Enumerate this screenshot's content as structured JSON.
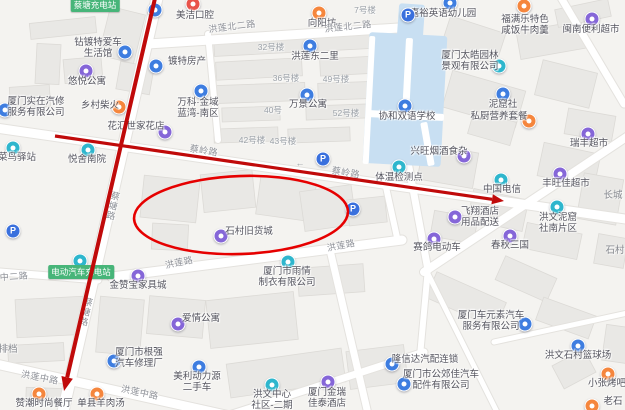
{
  "map": {
    "bg": "#f4f3f0",
    "road_fill": "#ffffff",
    "road_edge": "#e4e2de",
    "building_fill": "#e9e8e5",
    "building_edge": "#dcdad6",
    "water_fill": "#c8dff2",
    "annotation_color": "#c00a0a",
    "icon_colors": {
      "purple": "#8566d8",
      "blue": "#3e7de0",
      "teal": "#2eb6cd",
      "orange": "#f5863d",
      "red": "#e8534a",
      "parking": "#3a70dd"
    }
  },
  "pois": [
    {
      "name": "meijie-dental",
      "color": "red",
      "icon": [
        193,
        4
      ],
      "label": [
        195,
        16
      ],
      "lines": [
        "美洁口腔"
      ]
    },
    {
      "name": "station-marker",
      "color": "blue",
      "icon": [
        155,
        10
      ],
      "label": null,
      "lines": []
    },
    {
      "name": "xiangyangfang",
      "color": "orange",
      "icon": [
        319,
        13
      ],
      "label": [
        322,
        24
      ],
      "lines": [
        "向阳坊"
      ]
    },
    {
      "name": "jiayu-kindergarten",
      "color": "blue",
      "icon": [
        450,
        3
      ],
      "label": [
        443,
        14
      ],
      "lines": [
        "嘉裕英语幼儿园"
      ]
    },
    {
      "name": "fumanle",
      "color": "orange",
      "icon": [
        524,
        6
      ],
      "label": [
        525,
        20
      ],
      "lines": [
        "福满乐特色",
        "咸饭牛肉羹"
      ]
    },
    {
      "name": "minnan-store",
      "color": "purple",
      "icon": [
        592,
        19
      ],
      "label": [
        591,
        30
      ],
      "lines": [
        "闽南便利超市"
      ]
    },
    {
      "name": "honglian-dongerli",
      "color": "blue",
      "icon": [
        310,
        46
      ],
      "label": [
        315,
        57
      ],
      "lines": [
        "洪莲东二里"
      ]
    },
    {
      "name": "zuandute-car",
      "color": "blue",
      "icon": [
        125,
        52
      ],
      "label": [
        98,
        43
      ],
      "lines": [
        "钻镀特爱车",
        "生活馆"
      ]
    },
    {
      "name": "dute-realestate",
      "color": "blue",
      "icon": [
        156,
        66
      ],
      "label": [
        187,
        62
      ],
      "lines": [
        "镀特房产"
      ]
    },
    {
      "name": "youyue-apartment",
      "color": "purple",
      "icon": [
        86,
        71
      ],
      "label": [
        87,
        82
      ],
      "lines": [
        "悠悦公寓"
      ]
    },
    {
      "name": "vanke-lanwan",
      "color": "blue",
      "icon": [
        201,
        91
      ],
      "label": [
        198,
        103
      ],
      "lines": [
        "万科·金域",
        "蓝湾-南区"
      ]
    },
    {
      "name": "wanjing-apartment",
      "color": "blue",
      "icon": [
        307,
        95
      ],
      "label": [
        308,
        105
      ],
      "lines": [
        "万景公寓"
      ]
    },
    {
      "name": "xiehe-school",
      "color": "blue",
      "icon": [
        405,
        106
      ],
      "label": [
        407,
        117
      ],
      "lines": [
        "协和双语学校"
      ]
    },
    {
      "name": "shizai-autorepair",
      "color": "blue",
      "icon": [
        5,
        110
      ],
      "label": [
        36,
        102
      ],
      "lines": [
        "厦门实在汽修",
        "服务有限公司"
      ]
    },
    {
      "name": "xiangcun-chaihuo",
      "color": "orange",
      "icon": [
        119,
        107
      ],
      "label": [
        100,
        106
      ],
      "lines": [
        "乡村柴火"
      ]
    },
    {
      "name": "taihao-garden",
      "color": "teal",
      "icon": [
        499,
        66
      ],
      "label": [
        470,
        56
      ],
      "lines": [
        "厦门太皓园林",
        "景观有限公司"
      ]
    },
    {
      "name": "nikushe",
      "color": "blue",
      "icon": [
        503,
        94
      ],
      "label": [
        503,
        105
      ],
      "lines": [
        "泥窟社"
      ]
    },
    {
      "name": "sichu-meals",
      "color": "orange",
      "icon": [
        529,
        121
      ],
      "label": [
        499,
        117
      ],
      "lines": [
        "私厨营养套餐"
      ]
    },
    {
      "name": "huahui-florist",
      "color": "purple",
      "icon": [
        165,
        132
      ],
      "label": [
        136,
        127
      ],
      "lines": [
        "花汇世家花店"
      ]
    },
    {
      "name": "cainiao-post",
      "color": "teal",
      "icon": [
        13,
        148
      ],
      "label": [
        17,
        158
      ],
      "lines": [
        "菜鸟驿站"
      ]
    },
    {
      "name": "yueshe-nanyuan",
      "color": "teal",
      "icon": [
        88,
        150
      ],
      "label": [
        87,
        160
      ],
      "lines": [
        "悦舍南院"
      ]
    },
    {
      "name": "ruifeng-market",
      "color": "purple",
      "icon": [
        588,
        134
      ],
      "label": [
        589,
        144
      ],
      "lines": [
        "瑞丰超市"
      ]
    },
    {
      "name": "xingwang-tobacco",
      "color": "purple",
      "icon": [
        464,
        156
      ],
      "label": [
        439,
        152
      ],
      "lines": [
        "兴旺烟酒食杂"
      ]
    },
    {
      "name": "china-telecom",
      "color": "teal",
      "icon": [
        501,
        180
      ],
      "label": [
        502,
        190
      ],
      "lines": [
        "中国电信"
      ]
    },
    {
      "name": "temp-check-point",
      "color": "teal",
      "icon": [
        399,
        167
      ],
      "label": [
        399,
        178
      ],
      "lines": [
        "体温检测点"
      ]
    },
    {
      "name": "fengwangjia-market",
      "color": "purple",
      "icon": [
        560,
        174
      ],
      "label": [
        566,
        184
      ],
      "lines": [
        "丰旺佳超市"
      ]
    },
    {
      "name": "shicun-old-goods-city",
      "color": "purple",
      "icon": [
        221,
        236
      ],
      "label": [
        249,
        232
      ],
      "lines": [
        "石村旧货城"
      ]
    },
    {
      "name": "feixiang-hotel-supply",
      "color": "purple",
      "icon": [
        455,
        217
      ],
      "label": [
        480,
        212
      ],
      "lines": [
        "飞翔酒店",
        "用品配送"
      ]
    },
    {
      "name": "hongwen-niku-south",
      "color": "teal",
      "icon": [
        557,
        207
      ],
      "label": [
        558,
        218
      ],
      "lines": [
        "洪文泥窟",
        "社南片区"
      ]
    },
    {
      "name": "saige-ebike",
      "color": "purple",
      "icon": [
        434,
        239
      ],
      "label": [
        437,
        248
      ],
      "lines": [
        "赛鸽电动车"
      ]
    },
    {
      "name": "chunqiu-sanguo",
      "color": "purple",
      "icon": [
        510,
        236
      ],
      "label": [
        510,
        246
      ],
      "lines": [
        "春秋三国"
      ]
    },
    {
      "name": "ev-charging",
      "color": "teal",
      "icon": [
        80,
        261
      ],
      "label": null,
      "lines": []
    },
    {
      "name": "jinzanbao-furniture",
      "color": "purple",
      "icon": [
        138,
        276
      ],
      "label": [
        138,
        286
      ],
      "lines": [
        "金赞宝家具城"
      ]
    },
    {
      "name": "aiqing-apartment",
      "color": "purple",
      "icon": [
        178,
        324
      ],
      "label": [
        201,
        319
      ],
      "lines": [
        "爱情公寓"
      ]
    },
    {
      "name": "yuqing-garment",
      "color": "teal",
      "icon": [
        288,
        262
      ],
      "label": [
        287,
        272
      ],
      "lines": [
        "厦门市雨情",
        "制衣有限公司"
      ]
    },
    {
      "name": "genqiang-autorepair",
      "color": "blue",
      "icon": [
        114,
        361
      ],
      "label": [
        139,
        353
      ],
      "lines": [
        "厦门市根强",
        "汽车修理厂"
      ]
    },
    {
      "name": "meili-usedcar",
      "color": "blue",
      "icon": [
        199,
        367
      ],
      "label": [
        197,
        377
      ],
      "lines": [
        "美利动力源",
        "二手车"
      ]
    },
    {
      "name": "zanchao-restaurant",
      "color": "orange",
      "icon": [
        39,
        394
      ],
      "label": [
        44,
        404
      ],
      "lines": [
        "赞潮时尚餐厅"
      ]
    },
    {
      "name": "shanxian-muttonsoup",
      "color": "orange",
      "icon": [
        97,
        394
      ],
      "label": [
        101,
        404
      ],
      "lines": [
        "单县羊肉汤"
      ]
    },
    {
      "name": "hongwen-center-community",
      "color": "teal",
      "icon": [
        272,
        385
      ],
      "label": [
        272,
        395
      ],
      "lines": [
        "洪文中心",
        "社区-二期"
      ]
    },
    {
      "name": "jinrui-jiatai-hotel",
      "color": "purple",
      "icon": [
        328,
        382
      ],
      "label": [
        327,
        393
      ],
      "lines": [
        "厦门金瑞",
        "佳泰酒店"
      ]
    },
    {
      "name": "longxinda-autoparts",
      "color": "blue",
      "icon": [
        392,
        364
      ],
      "label": [
        425,
        360
      ],
      "lines": [
        "隆信达汽配连锁"
      ]
    },
    {
      "name": "gongjiaojia-autoparts",
      "color": "blue",
      "icon": [
        404,
        384
      ],
      "label": [
        441,
        375
      ],
      "lines": [
        "厦门市公郊佳汽车",
        "配件有限公司"
      ]
    },
    {
      "name": "cheyuansu-auto",
      "color": "blue",
      "icon": [
        525,
        324
      ],
      "label": [
        491,
        316
      ],
      "lines": [
        "厦门车元素汽车",
        "服务有限公司"
      ]
    },
    {
      "name": "shicun-basketball-court",
      "color": "blue",
      "icon": [
        578,
        346
      ],
      "label": [
        578,
        356
      ],
      "lines": [
        "洪文石村篮球场"
      ]
    },
    {
      "name": "xiaozhang-bbq",
      "color": "orange",
      "icon": [
        608,
        374
      ],
      "label": [
        607,
        384
      ],
      "lines": [
        "小张烤吧"
      ]
    },
    {
      "name": "laoshi-bbq",
      "color": "orange",
      "icon": [
        592,
        406
      ],
      "label": [
        613,
        402
      ],
      "lines": [
        "老石"
      ]
    },
    {
      "name": "parking-1",
      "color": "parking",
      "glyph": "P",
      "icon": [
        13,
        231
      ],
      "label": null,
      "lines": []
    },
    {
      "name": "parking-2",
      "color": "parking",
      "glyph": "P",
      "icon": [
        323,
        159
      ],
      "label": null,
      "lines": []
    },
    {
      "name": "parking-3",
      "color": "parking",
      "glyph": "P",
      "icon": [
        353,
        209
      ],
      "label": null,
      "lines": []
    },
    {
      "name": "parking-4",
      "color": "parking",
      "glyph": "P",
      "icon": [
        408,
        15
      ],
      "label": null,
      "lines": []
    }
  ],
  "green_labels": [
    {
      "text": "蔡塘充电站",
      "x": 95,
      "y": 5
    },
    {
      "text": "电动汽车充电站",
      "x": 81,
      "y": 272
    }
  ],
  "road_labels": [
    {
      "text": "洪莲北二路",
      "x": 232,
      "y": 26,
      "rot": -7
    },
    {
      "text": "洪莲北二路",
      "x": 348,
      "y": 26,
      "rot": -6
    },
    {
      "text": "蔡塘路",
      "x": 113,
      "y": 206,
      "rot": 13,
      "vert": true
    },
    {
      "text": "蔡塘路",
      "x": 86,
      "y": 312,
      "rot": 13,
      "vert": true
    },
    {
      "text": "蔡岭路",
      "x": 204,
      "y": 150,
      "rot": 9
    },
    {
      "text": "蔡岭路",
      "x": 346,
      "y": 172,
      "rot": 9
    },
    {
      "text": "洪莲路",
      "x": 179,
      "y": 262,
      "rot": -12
    },
    {
      "text": "洪莲路",
      "x": 341,
      "y": 245,
      "rot": -11
    },
    {
      "text": "洪莲中路",
      "x": 40,
      "y": 377,
      "rot": 11
    },
    {
      "text": "洪莲中路",
      "x": 140,
      "y": 392,
      "rot": 12
    },
    {
      "text": "中二路",
      "x": 14,
      "y": 276,
      "rot": -4
    }
  ],
  "area_labels": [
    {
      "text": "7号楼",
      "x": 365,
      "y": 10,
      "cls": "num"
    },
    {
      "text": "32号楼",
      "x": 271,
      "y": 47,
      "cls": "num"
    },
    {
      "text": "36号楼",
      "x": 286,
      "y": 78,
      "cls": "num"
    },
    {
      "text": "49号楼",
      "x": 336,
      "y": 79,
      "cls": "num"
    },
    {
      "text": "40号",
      "x": 273,
      "y": 110,
      "cls": "num"
    },
    {
      "text": "52号楼",
      "x": 346,
      "y": 113,
      "cls": "num"
    },
    {
      "text": "42号楼",
      "x": 252,
      "y": 140,
      "cls": "num"
    },
    {
      "text": "43号楼",
      "x": 283,
      "y": 141,
      "cls": "num"
    },
    {
      "text": "长城",
      "x": 613,
      "y": 194,
      "cls": "place"
    },
    {
      "text": "石村",
      "x": 615,
      "y": 249,
      "cls": "place"
    },
    {
      "text": "排档",
      "x": 8,
      "y": 348,
      "cls": "place"
    },
    {
      "text": "←",
      "x": 300,
      "y": 163,
      "cls": "oneway"
    }
  ],
  "buildings": [
    [
      30,
      20,
      66,
      16,
      -6
    ],
    [
      104,
      10,
      36,
      50,
      14
    ],
    [
      36,
      44,
      24,
      40,
      3
    ],
    [
      64,
      58,
      38,
      24,
      -5
    ],
    [
      118,
      64,
      34,
      28,
      10
    ],
    [
      10,
      86,
      40,
      22,
      -4
    ],
    [
      214,
      36,
      94,
      18,
      -3
    ],
    [
      314,
      33,
      92,
      16,
      -3
    ],
    [
      216,
      60,
      86,
      18,
      -3
    ],
    [
      320,
      57,
      78,
      17,
      -3
    ],
    [
      215,
      84,
      90,
      18,
      -2
    ],
    [
      318,
      82,
      76,
      17,
      -2
    ],
    [
      222,
      107,
      58,
      14,
      -2
    ],
    [
      306,
      105,
      62,
      14,
      -2
    ],
    [
      214,
      128,
      64,
      14,
      -2
    ],
    [
      288,
      128,
      62,
      14,
      -2
    ],
    [
      444,
      24,
      58,
      34,
      18
    ],
    [
      518,
      26,
      66,
      28,
      -10
    ],
    [
      556,
      4,
      54,
      18,
      -12
    ],
    [
      446,
      80,
      76,
      38,
      16
    ],
    [
      538,
      66,
      56,
      36,
      14
    ],
    [
      566,
      112,
      48,
      26,
      10
    ],
    [
      470,
      116,
      44,
      24,
      16
    ],
    [
      142,
      178,
      56,
      42,
      6
    ],
    [
      202,
      172,
      52,
      38,
      -6
    ],
    [
      258,
      180,
      56,
      38,
      8
    ],
    [
      302,
      188,
      52,
      40,
      -8
    ],
    [
      152,
      224,
      36,
      26,
      3
    ],
    [
      348,
      198,
      38,
      26,
      -6
    ],
    [
      420,
      148,
      56,
      36,
      10
    ],
    [
      540,
      148,
      58,
      34,
      12
    ],
    [
      470,
      194,
      56,
      32,
      12
    ],
    [
      580,
      176,
      40,
      46,
      10
    ],
    [
      432,
      214,
      44,
      26,
      10
    ],
    [
      524,
      228,
      56,
      26,
      12
    ],
    [
      596,
      236,
      30,
      30,
      10
    ],
    [
      16,
      298,
      68,
      38,
      -3
    ],
    [
      8,
      344,
      56,
      18,
      -3
    ],
    [
      98,
      298,
      44,
      56,
      5
    ],
    [
      148,
      298,
      56,
      38,
      5
    ],
    [
      26,
      388,
      40,
      14,
      2
    ],
    [
      208,
      296,
      88,
      48,
      -6
    ],
    [
      228,
      356,
      116,
      34,
      -8
    ],
    [
      348,
      348,
      58,
      38,
      -7
    ],
    [
      298,
      266,
      66,
      28,
      -4
    ],
    [
      428,
      286,
      76,
      28,
      24
    ],
    [
      498,
      266,
      56,
      26,
      24
    ],
    [
      538,
      306,
      56,
      24,
      20
    ],
    [
      556,
      356,
      36,
      26,
      -28
    ],
    [
      604,
      326,
      26,
      36,
      8
    ]
  ],
  "roads": [
    [
      158,
      -6,
      62,
      416,
      11
    ],
    [
      -4,
      128,
      632,
      220,
      9
    ],
    [
      148,
      44,
      414,
      27,
      9
    ],
    [
      112,
      277,
      402,
      240,
      9
    ],
    [
      424,
      272,
      628,
      136,
      8
    ],
    [
      -4,
      364,
      248,
      420,
      9
    ],
    [
      0,
      272,
      98,
      280,
      7
    ],
    [
      208,
      34,
      218,
      140,
      6
    ],
    [
      408,
      162,
      428,
      270,
      7
    ],
    [
      226,
      416,
      424,
      352,
      7
    ],
    [
      420,
      356,
      428,
      268,
      6
    ],
    [
      330,
      250,
      368,
      414,
      7
    ],
    [
      560,
      -4,
      624,
      104,
      7
    ],
    [
      428,
      274,
      498,
      414,
      5
    ],
    [
      494,
      342,
      632,
      312,
      5
    ],
    [
      384,
      178,
      398,
      242,
      6
    ]
  ],
  "water": [
    [
      398,
      4,
      26,
      34,
      4
    ],
    [
      366,
      34,
      78,
      131,
      3
    ]
  ],
  "water_lanes": [
    [
      404,
      38,
      7,
      78,
      3
    ],
    [
      368,
      112,
      76,
      7,
      3
    ],
    [
      424,
      122,
      7,
      44,
      -10
    ],
    [
      366,
      36,
      6,
      128,
      3
    ]
  ],
  "annotations": {
    "arrows": [
      {
        "x1": 156,
        "y1": -6,
        "x2": 64,
        "y2": 391,
        "w": 4,
        "head": 14
      },
      {
        "x1": 55,
        "y1": 136,
        "x2": 504,
        "y2": 201,
        "w": 3.2,
        "head": 12
      }
    ],
    "ellipse": {
      "cx": 241,
      "cy": 215,
      "rx": 107,
      "ry": 39,
      "rot": -2,
      "w": 2.6
    }
  }
}
